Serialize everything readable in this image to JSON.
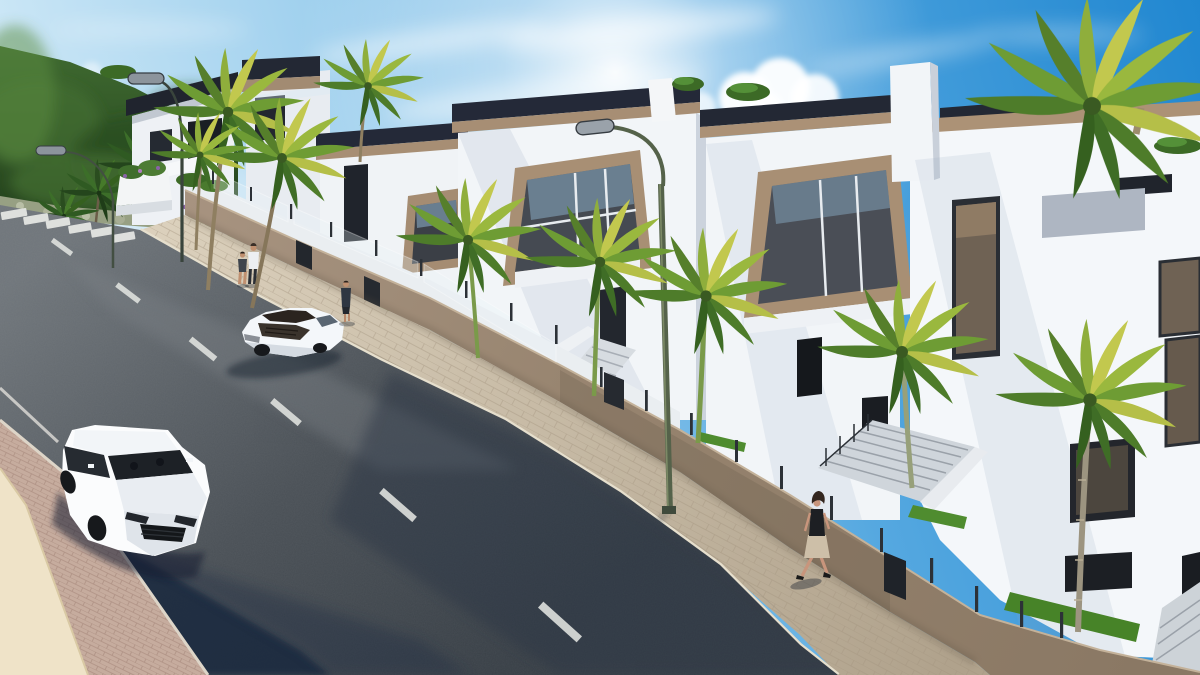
{
  "meta": {
    "description": "Photorealistic 3D architectural rendering of a new residential development: a row of modern white three-storey townhouses with dark roof parapets and beige accent panels along a palm-lined uphill street, a white luxury SUV and a white sports car on the road, pedestrians on the sidewalks, curved street lamps, a zebra crosswalk and a green hillside under a bright blue sky with scattered clouds.",
    "visible_text": [],
    "width": 1200,
    "height": 675
  },
  "palette": {
    "sky_deep": "#1f86d0",
    "sky_pale": "#cfe9f6",
    "cloud": "#ffffff",
    "hill_dark_green": "#2a4a22",
    "foliage_light": "#6e9c34",
    "frond_yellow": "#c2c84e",
    "building_white": "#f2f5f8",
    "building_shade": "#c9d0da",
    "parapet_dark": "#232834",
    "accent_tan": "#a88f74",
    "glass_dark": "#3b3f46",
    "glass_bronze": "#6f6254",
    "glass_sky_reflection": "#8fb3cd",
    "boundary_wall_tan": "#9b8874",
    "sidewalk_stone": "#c9bda9",
    "curb_light": "#e6dfcd",
    "paver_pink": "#c6ac9e",
    "road_asphalt": "#4a5056",
    "road_shadow_blue": "#17263c",
    "marking_white": "#e8e9e6",
    "lamp_green": "#55624a",
    "palm_trunk_brown": "#8f7f61",
    "palm_trunk_green": "#7a9a4a",
    "grass_green": "#4f8c2f",
    "car_white": "#f7fafc",
    "car_roof_brown": "#2b241f",
    "skin_tone": "#c8957c",
    "cream_wall": "#efe3c8"
  },
  "scene": {
    "sky": {
      "condition": "sunny, wispy cirrus and small cumulus clouds",
      "sun_glow": "upper center-left"
    },
    "hillside": {
      "position": "upper left",
      "cover": "dense green vegetation, palm trees, rocky base"
    },
    "buildings": {
      "count_visible": 6,
      "style": "modern white townhouses",
      "features": [
        "dark roof parapets",
        "beige slanted window surrounds",
        "dark glazed windows",
        "roof terraces",
        "entrance stairs",
        "tan boundary walls with glass balustrades"
      ]
    },
    "road": {
      "type": "asphalt street sloping uphill to the left",
      "markings": [
        "zebra crosswalk upper left",
        "dashed white center line",
        "white edge line lower left"
      ]
    },
    "vehicles": [
      {
        "name": "white-suv",
        "description": "white luxury SUV driving downhill with two occupants",
        "position": "lower left"
      },
      {
        "name": "white-sports-car",
        "description": "white sports car with dark roof heading uphill",
        "position": "middle left"
      }
    ],
    "pedestrians": [
      {
        "name": "adult-with-child",
        "description": "adult in white shirt walking with a child on the upper sidewalk"
      },
      {
        "name": "person-standing",
        "description": "person in dark top standing by the boundary wall"
      },
      {
        "name": "woman-walking",
        "description": "woman in dark top and beige skirt walking downhill on the right sidewalk"
      }
    ],
    "street_lamps": {
      "count": 3,
      "style": "curved arc poles with capsule heads"
    },
    "palm_trees": {
      "foreground_count": 9,
      "background_count": 8
    },
    "planters": {
      "description": "white planter boxes with shrubs and purple flowers near the crosswalk"
    }
  }
}
